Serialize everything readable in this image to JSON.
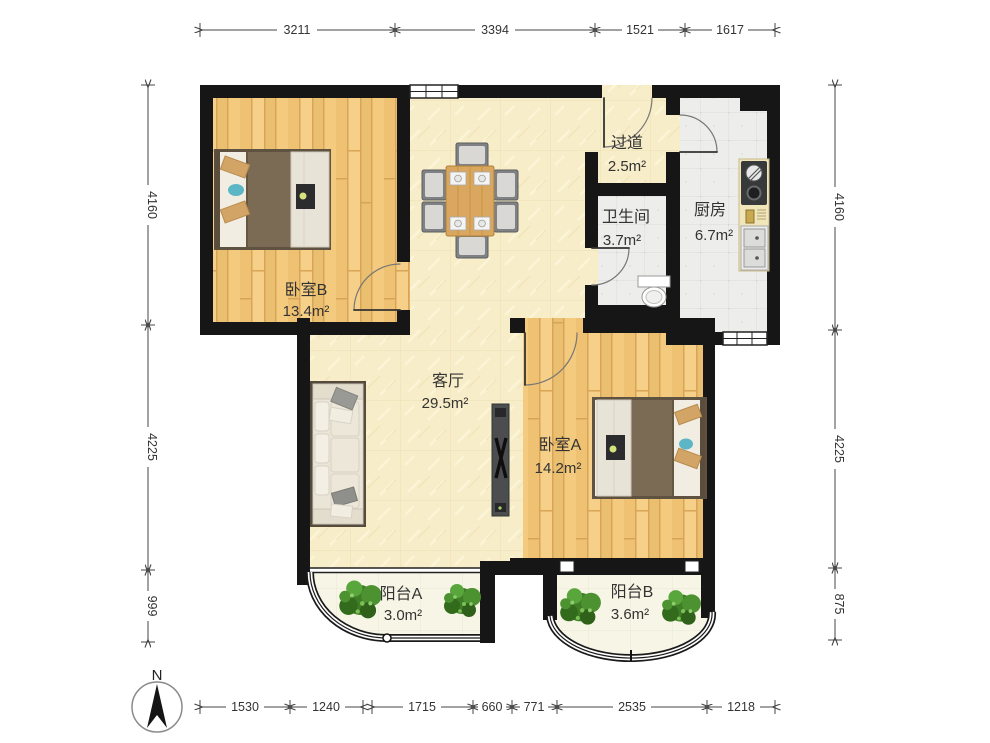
{
  "compass": {
    "label": "N"
  },
  "rooms": {
    "bedroom_b": {
      "name": "卧室B",
      "area": "13.4m²"
    },
    "hallway": {
      "name": "过道",
      "area": "2.5m²"
    },
    "bathroom": {
      "name": "卫生间",
      "area": "3.7m²"
    },
    "kitchen": {
      "name": "厨房",
      "area": "6.7m²"
    },
    "living": {
      "name": "客厅",
      "area": "29.5m²"
    },
    "bedroom_a": {
      "name": "卧室A",
      "area": "14.2m²"
    },
    "balcony_a": {
      "name": "阳台A",
      "area": "3.0m²"
    },
    "balcony_b": {
      "name": "阳台B",
      "area": "3.6m²"
    }
  },
  "dimensions_mm": {
    "top": [
      "3211",
      "3394",
      "1521",
      "1617"
    ],
    "left": [
      "4160",
      "4225",
      "999"
    ],
    "right": [
      "4160",
      "4225",
      "875"
    ],
    "bottom": [
      "1530",
      "1240",
      "1715",
      "660",
      "771",
      "2535",
      "1218"
    ]
  },
  "palette": {
    "wall": "#161616",
    "wood_floor": "#f3c87d",
    "living_floor": "#f8edc9",
    "tile_floor": "#ededeb",
    "balcony_floor": "#f7f6e6",
    "blanket": "#7b6b54",
    "pillow_tan": "#d2a566",
    "pillow_teal": "#5cb6c6",
    "plant_green": "#3f7d27",
    "dim_text": "#333333"
  }
}
